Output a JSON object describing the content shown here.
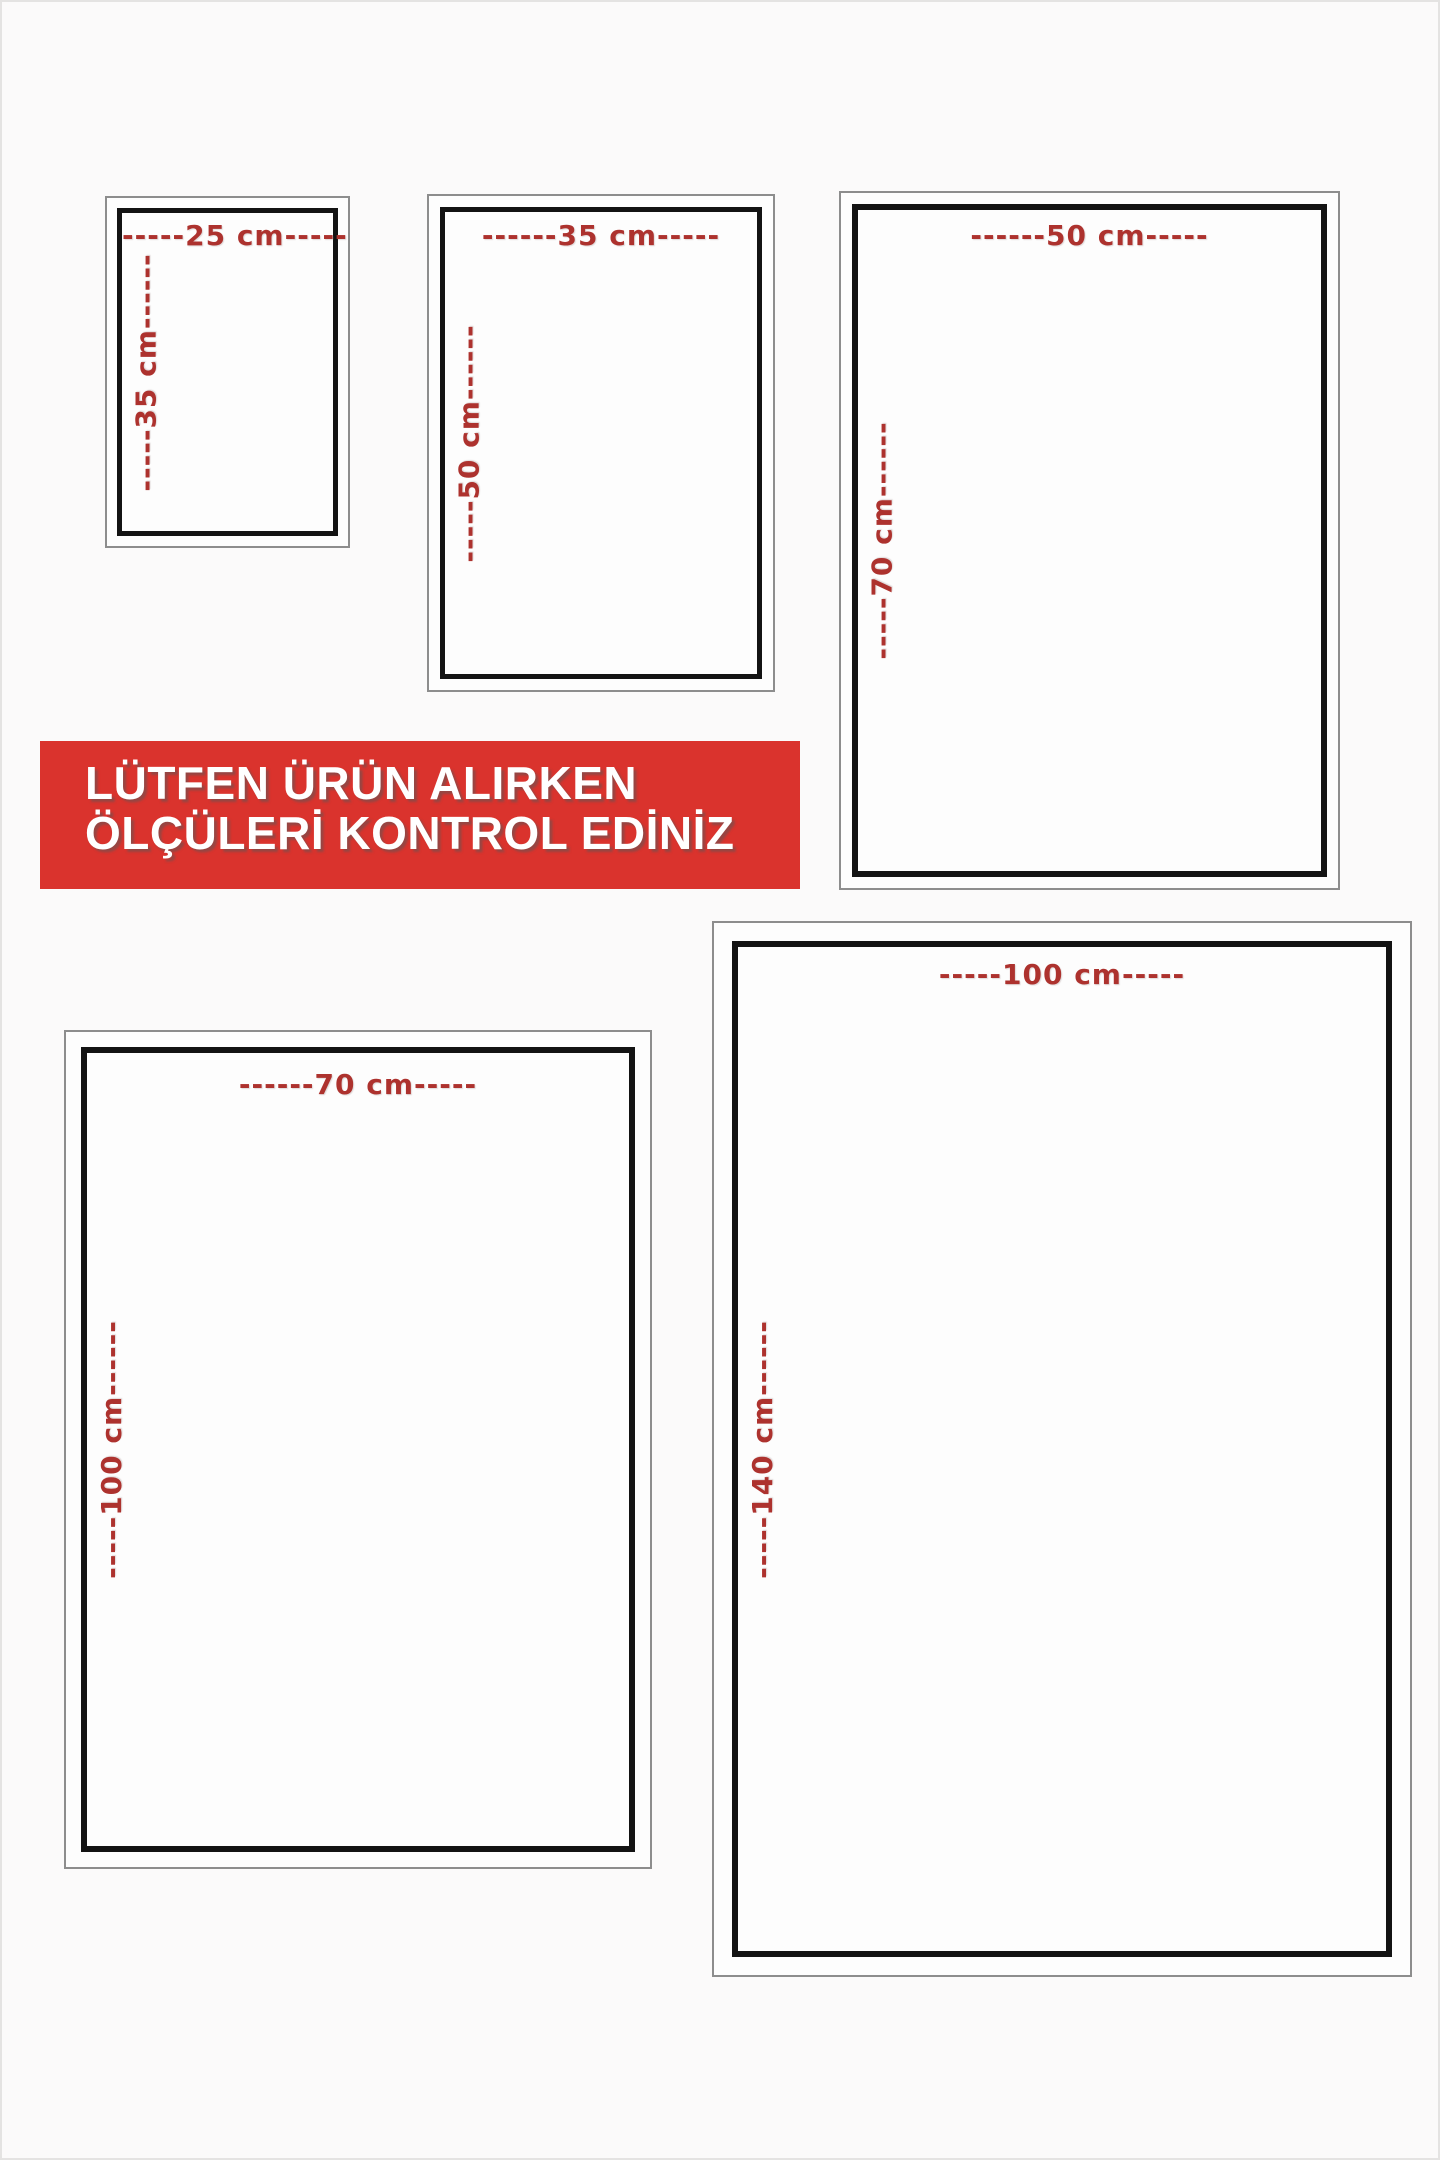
{
  "banner": {
    "line1": "LÜTFEN ÜRÜN ALIRKEN",
    "line2": "ÖLÇÜLERİ KONTROL EDİNİZ",
    "bg_color": "#da332d",
    "text_color": "#ffffff"
  },
  "label_color": "#ad322e",
  "frame_colors": {
    "outer": "#8d8d8d",
    "inner": "#131313"
  },
  "sizes": [
    {
      "name": "25x35 cm",
      "width_cm": 25,
      "height_cm": 35,
      "width_label": "-----25 cm-----",
      "height_label": "-----35 cm------"
    },
    {
      "name": "35x50 cm",
      "width_cm": 35,
      "height_cm": 50,
      "width_label": "------35 cm-----",
      "height_label": "-----50 cm------"
    },
    {
      "name": "50x70 cm",
      "width_cm": 50,
      "height_cm": 70,
      "width_label": "------50 cm-----",
      "height_label": "-----70 cm------"
    },
    {
      "name": "70x100 cm",
      "width_cm": 70,
      "height_cm": 100,
      "width_label": "------70 cm-----",
      "height_label": "-----100 cm------"
    },
    {
      "name": "100x140 cm",
      "width_cm": 100,
      "height_cm": 140,
      "width_label": "-----100 cm-----",
      "height_label": "-----140 cm------"
    }
  ]
}
